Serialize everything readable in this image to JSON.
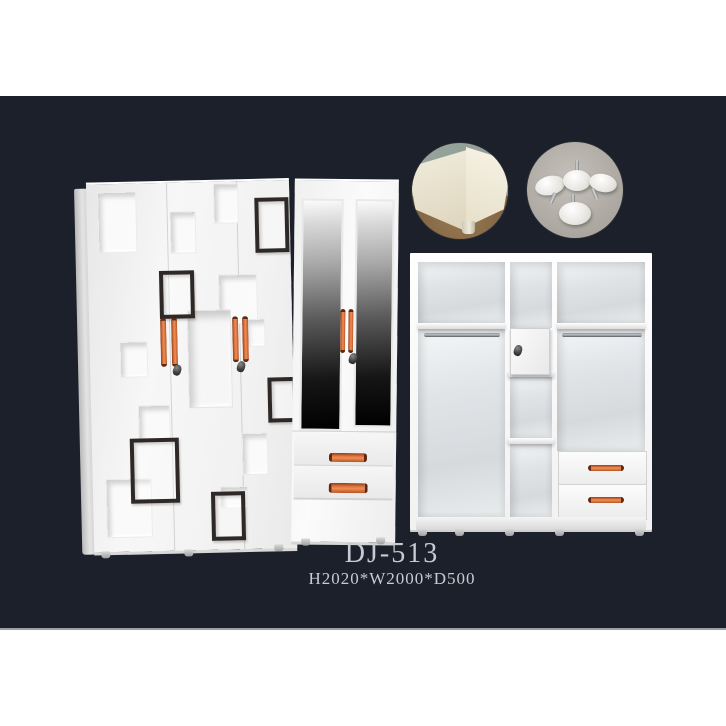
{
  "product": {
    "model": "DJ-513",
    "dimensions": "H2020*W2000*D500"
  },
  "palette": {
    "backdrop_dark": "#1c202a",
    "band_white": "#ffffff",
    "cabinet_white": "#f4f4f4",
    "handle_orange": "#df7540",
    "decor_frame_dark": "#2e2926",
    "mirror_dark": "#161616",
    "caption_text": "#c7cbd2",
    "detail_floor_brown": "#7d6142",
    "detail_concrete_gray": "#a9a59e"
  },
  "scene": {
    "description_names": {
      "left_unit": "patterned-wardrobe-closed",
      "middle_unit": "mirror-door-wardrobe-with-drawers",
      "right_unit": "wardrobe-interior-open-view",
      "circle_1": "corner-leg-detail-photo",
      "circle_2": "adjustable-feet-hardware-photo"
    },
    "render_items": [
      {
        "host": "left-face",
        "cls": "niche",
        "name": "decor-niche",
        "x": 11,
        "y": 8,
        "w": 37,
        "h": 59
      },
      {
        "host": "left-face",
        "cls": "niche",
        "name": "decor-niche",
        "x": 83,
        "y": 29,
        "w": 24,
        "h": 40
      },
      {
        "host": "left-face",
        "cls": "niche",
        "name": "decor-niche",
        "x": 127,
        "y": 2,
        "w": 23,
        "h": 38
      },
      {
        "host": "left-face",
        "cls": "niche",
        "name": "decor-niche",
        "x": 130,
        "y": 93,
        "w": 37,
        "h": 48
      },
      {
        "host": "left-face",
        "cls": "niche",
        "name": "decor-niche",
        "x": 156,
        "y": 138,
        "w": 18,
        "h": 26
      },
      {
        "host": "left-face",
        "cls": "niche-big",
        "name": "decor-niche-large",
        "x": 98,
        "y": 128,
        "w": 42,
        "h": 96
      },
      {
        "host": "left-face",
        "cls": "niche",
        "name": "decor-niche",
        "x": 30,
        "y": 158,
        "w": 26,
        "h": 34
      },
      {
        "host": "left-face",
        "cls": "niche",
        "name": "decor-niche",
        "x": 47,
        "y": 222,
        "w": 30,
        "h": 37
      },
      {
        "host": "left-face",
        "cls": "niche",
        "name": "decor-niche",
        "x": 13,
        "y": 295,
        "w": 44,
        "h": 57
      },
      {
        "host": "left-face",
        "cls": "niche",
        "name": "decor-niche",
        "x": 150,
        "y": 252,
        "w": 24,
        "h": 40
      },
      {
        "host": "left-face",
        "cls": "niche",
        "name": "decor-niche",
        "x": 127,
        "y": 305,
        "w": 26,
        "h": 20
      },
      {
        "host": "left-face",
        "cls": "dframe",
        "name": "decor-frame",
        "x": 168,
        "y": 17,
        "w": 26,
        "h": 47
      },
      {
        "host": "left-face",
        "cls": "dframe",
        "name": "decor-frame",
        "x": 71,
        "y": 88,
        "w": 27,
        "h": 40
      },
      {
        "host": "left-face",
        "cls": "dframe",
        "name": "decor-frame",
        "x": 177,
        "y": 197,
        "w": 21,
        "h": 37
      },
      {
        "host": "left-face",
        "cls": "dframe",
        "name": "decor-frame",
        "x": 38,
        "y": 255,
        "w": 41,
        "h": 57
      },
      {
        "host": "left-face",
        "cls": "dframe",
        "name": "decor-frame",
        "x": 118,
        "y": 310,
        "w": 26,
        "h": 41
      },
      {
        "host": "left-face",
        "cls": "handle-v",
        "name": "door-handle",
        "x": 71,
        "y": 135,
        "w": 6,
        "h": 43
      },
      {
        "host": "left-face",
        "cls": "handle-v",
        "name": "door-handle",
        "x": 82,
        "y": 135,
        "w": 6,
        "h": 43
      },
      {
        "host": "left-face",
        "cls": "handle-v",
        "name": "door-handle",
        "x": 143,
        "y": 135,
        "w": 6,
        "h": 40
      },
      {
        "host": "left-face",
        "cls": "handle-v",
        "name": "door-handle",
        "x": 153,
        "y": 135,
        "w": 6,
        "h": 40
      },
      {
        "host": "left-face",
        "cls": "lock",
        "name": "door-lock",
        "x": 83,
        "y": 182
      },
      {
        "host": "left-face",
        "cls": "lock",
        "name": "door-lock",
        "x": 147,
        "y": 180
      },
      {
        "host": "mirror-unit",
        "cls": "handle-v",
        "name": "mirror-door-handle",
        "x": 47,
        "y": 128,
        "w": 5,
        "h": 38
      },
      {
        "host": "mirror-unit",
        "cls": "handle-v",
        "name": "mirror-door-handle",
        "x": 55,
        "y": 128,
        "w": 5,
        "h": 38
      },
      {
        "host": "mirror-unit",
        "cls": "lock",
        "name": "mirror-door-lock",
        "x": 56,
        "y": 172
      },
      {
        "host": "mirror-unit",
        "cls": "handle-h",
        "name": "drawer-handle",
        "x": 37,
        "y": 272,
        "w": 32,
        "h": 9
      },
      {
        "host": "mirror-unit",
        "cls": "handle-h",
        "name": "drawer-handle",
        "x": 37,
        "y": 302,
        "w": 33,
        "h": 10
      },
      {
        "host": "interior-unit",
        "cls": "handle-h",
        "name": "drawer-handle",
        "x": 178,
        "y": 212,
        "w": 30,
        "h": 6
      },
      {
        "host": "interior-unit",
        "cls": "handle-h",
        "name": "drawer-handle",
        "x": 178,
        "y": 244,
        "w": 30,
        "h": 6
      },
      {
        "host": "interior-unit",
        "cls": "lock",
        "name": "locker-lock",
        "x": 104,
        "y": 92
      },
      {
        "host": "left-wardrobe",
        "cls": "foot-nub",
        "name": "wardrobe-foot",
        "x": 97,
        "y": 453
      },
      {
        "host": "left-wardrobe",
        "cls": "foot-nub",
        "name": "wardrobe-foot",
        "x": 180,
        "y": 453
      },
      {
        "host": "left-wardrobe",
        "cls": "foot-nub",
        "name": "wardrobe-foot",
        "x": 270,
        "y": 450
      },
      {
        "host": "mirror-unit",
        "cls": "foot-nub",
        "name": "wardrobe-foot",
        "x": 10,
        "y": 358
      },
      {
        "host": "mirror-unit",
        "cls": "foot-nub",
        "name": "wardrobe-foot",
        "x": 85,
        "y": 356
      },
      {
        "host": "interior-unit",
        "cls": "foot-nub",
        "name": "wardrobe-foot",
        "x": 8,
        "y": 276
      },
      {
        "host": "interior-unit",
        "cls": "foot-nub",
        "name": "wardrobe-foot",
        "x": 45,
        "y": 276
      },
      {
        "host": "interior-unit",
        "cls": "foot-nub",
        "name": "wardrobe-foot",
        "x": 95,
        "y": 276
      },
      {
        "host": "interior-unit",
        "cls": "foot-nub",
        "name": "wardrobe-foot",
        "x": 145,
        "y": 276
      },
      {
        "host": "interior-unit",
        "cls": "foot-nub",
        "name": "wardrobe-foot",
        "x": 225,
        "y": 276
      }
    ]
  }
}
